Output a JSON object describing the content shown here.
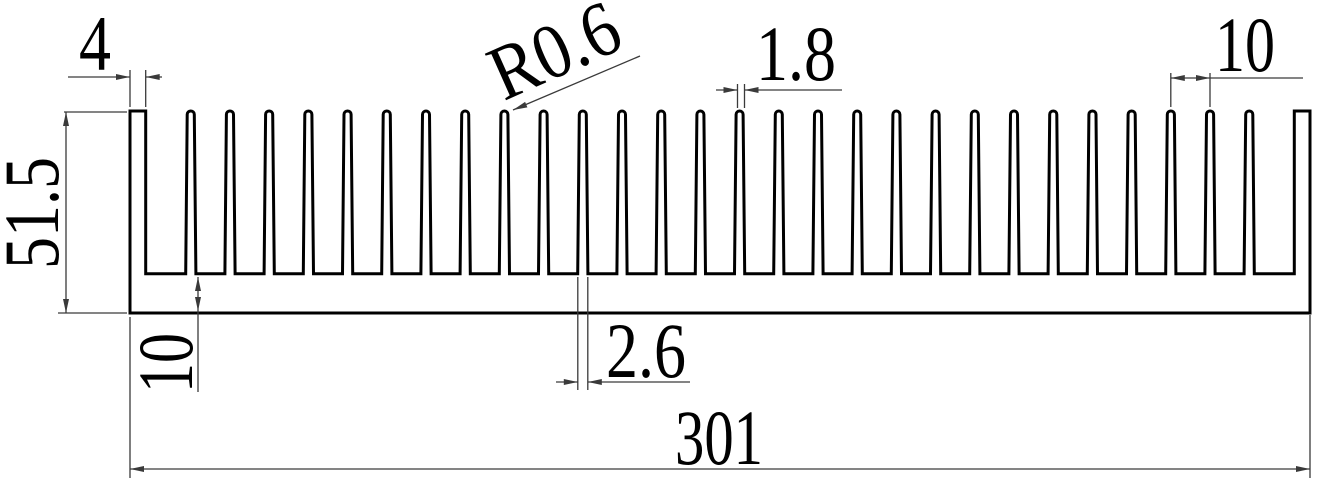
{
  "drawing": {
    "kind": "technical-drawing",
    "description": "Heat sink extrusion cross-section with dimension annotations",
    "units": "mm"
  },
  "labels": {
    "end_fin_width": "4",
    "overall_height": "51.5",
    "base_thickness": "10",
    "tip_radius": "R0.6",
    "fin_tip_width": "1.8",
    "fin_pitch": "10",
    "fin_root_width": "2.6",
    "overall_width": "301"
  },
  "profile": {
    "overall_width_mm": 301,
    "overall_height_mm": 51.5,
    "base_thickness_mm": 10,
    "end_fin_width_mm": 4,
    "fin_pitch_mm": 10,
    "thin_fin_count": 28,
    "first_fin_center_offset_mm": 15.5,
    "fin_tip_width_mm": 1.8,
    "fin_root_width_mm": 2.6,
    "tip_radius_mm": 0.6
  },
  "colors": {
    "outline": "#000000",
    "dimension": "#3a3a3a",
    "background": "#ffffff"
  }
}
